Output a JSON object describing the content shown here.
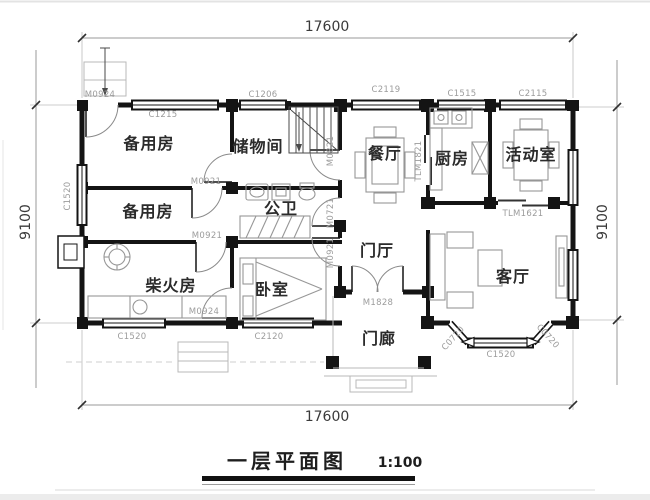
{
  "title": {
    "text": "一层平面图",
    "scale": "1:100"
  },
  "dimensions": {
    "top": "17600",
    "bottom": "17600",
    "left": "9100",
    "right": "9100"
  },
  "rooms": [
    {
      "name": "备用房",
      "x": 149,
      "y": 149
    },
    {
      "name": "储物间",
      "x": 258,
      "y": 152
    },
    {
      "name": "餐厅",
      "x": 385,
      "y": 159
    },
    {
      "name": "厨房",
      "x": 452,
      "y": 164
    },
    {
      "name": "活动室",
      "x": 531,
      "y": 160
    },
    {
      "name": "备用房",
      "x": 148,
      "y": 217
    },
    {
      "name": "公卫",
      "x": 281,
      "y": 214
    },
    {
      "name": "门厅",
      "x": 377,
      "y": 256
    },
    {
      "name": "柴火房",
      "x": 171,
      "y": 291
    },
    {
      "name": "卧室",
      "x": 272,
      "y": 295
    },
    {
      "name": "客厅",
      "x": 513,
      "y": 282
    },
    {
      "name": "门廊",
      "x": 379,
      "y": 344
    }
  ],
  "door_window_labels": [
    {
      "code": "M0924",
      "x": 100,
      "y": 97,
      "rot": 0
    },
    {
      "code": "C1215",
      "x": 163,
      "y": 117,
      "rot": 0
    },
    {
      "code": "C1206",
      "x": 263,
      "y": 97,
      "rot": 0
    },
    {
      "code": "C2119",
      "x": 386,
      "y": 92,
      "rot": 0
    },
    {
      "code": "C1515",
      "x": 462,
      "y": 96,
      "rot": 0
    },
    {
      "code": "C2115",
      "x": 533,
      "y": 96,
      "rot": 0
    },
    {
      "code": "C1520",
      "x": 70,
      "y": 196,
      "rot": -90
    },
    {
      "code": "M0921",
      "x": 206,
      "y": 184,
      "rot": 0
    },
    {
      "code": "M0921",
      "x": 207,
      "y": 238,
      "rot": 0
    },
    {
      "code": "M0924",
      "x": 204,
      "y": 314,
      "rot": 0
    },
    {
      "code": "M0821",
      "x": 333,
      "y": 151,
      "rot": -90
    },
    {
      "code": "M0721",
      "x": 333,
      "y": 213,
      "rot": -90
    },
    {
      "code": "M0921",
      "x": 333,
      "y": 253,
      "rot": -90
    },
    {
      "code": "TLM1821",
      "x": 421,
      "y": 161,
      "rot": -90
    },
    {
      "code": "TLM1621",
      "x": 523,
      "y": 216,
      "rot": 0
    },
    {
      "code": "M1828",
      "x": 378,
      "y": 305,
      "rot": 0
    },
    {
      "code": "C1520",
      "x": 132,
      "y": 339,
      "rot": 0
    },
    {
      "code": "C2120",
      "x": 269,
      "y": 339,
      "rot": 0
    },
    {
      "code": "C0720",
      "x": 455,
      "y": 340,
      "rot": -48
    },
    {
      "code": "C1520",
      "x": 501,
      "y": 357,
      "rot": 0
    },
    {
      "code": "C0720",
      "x": 546,
      "y": 338,
      "rot": 48
    }
  ],
  "colors": {
    "wall": "#141414",
    "room_text": "#2b2b2b",
    "code_text": "#9c9c9c",
    "furniture": "#979797",
    "dimension_text": "#3a3a3a",
    "background": "#ffffff"
  }
}
